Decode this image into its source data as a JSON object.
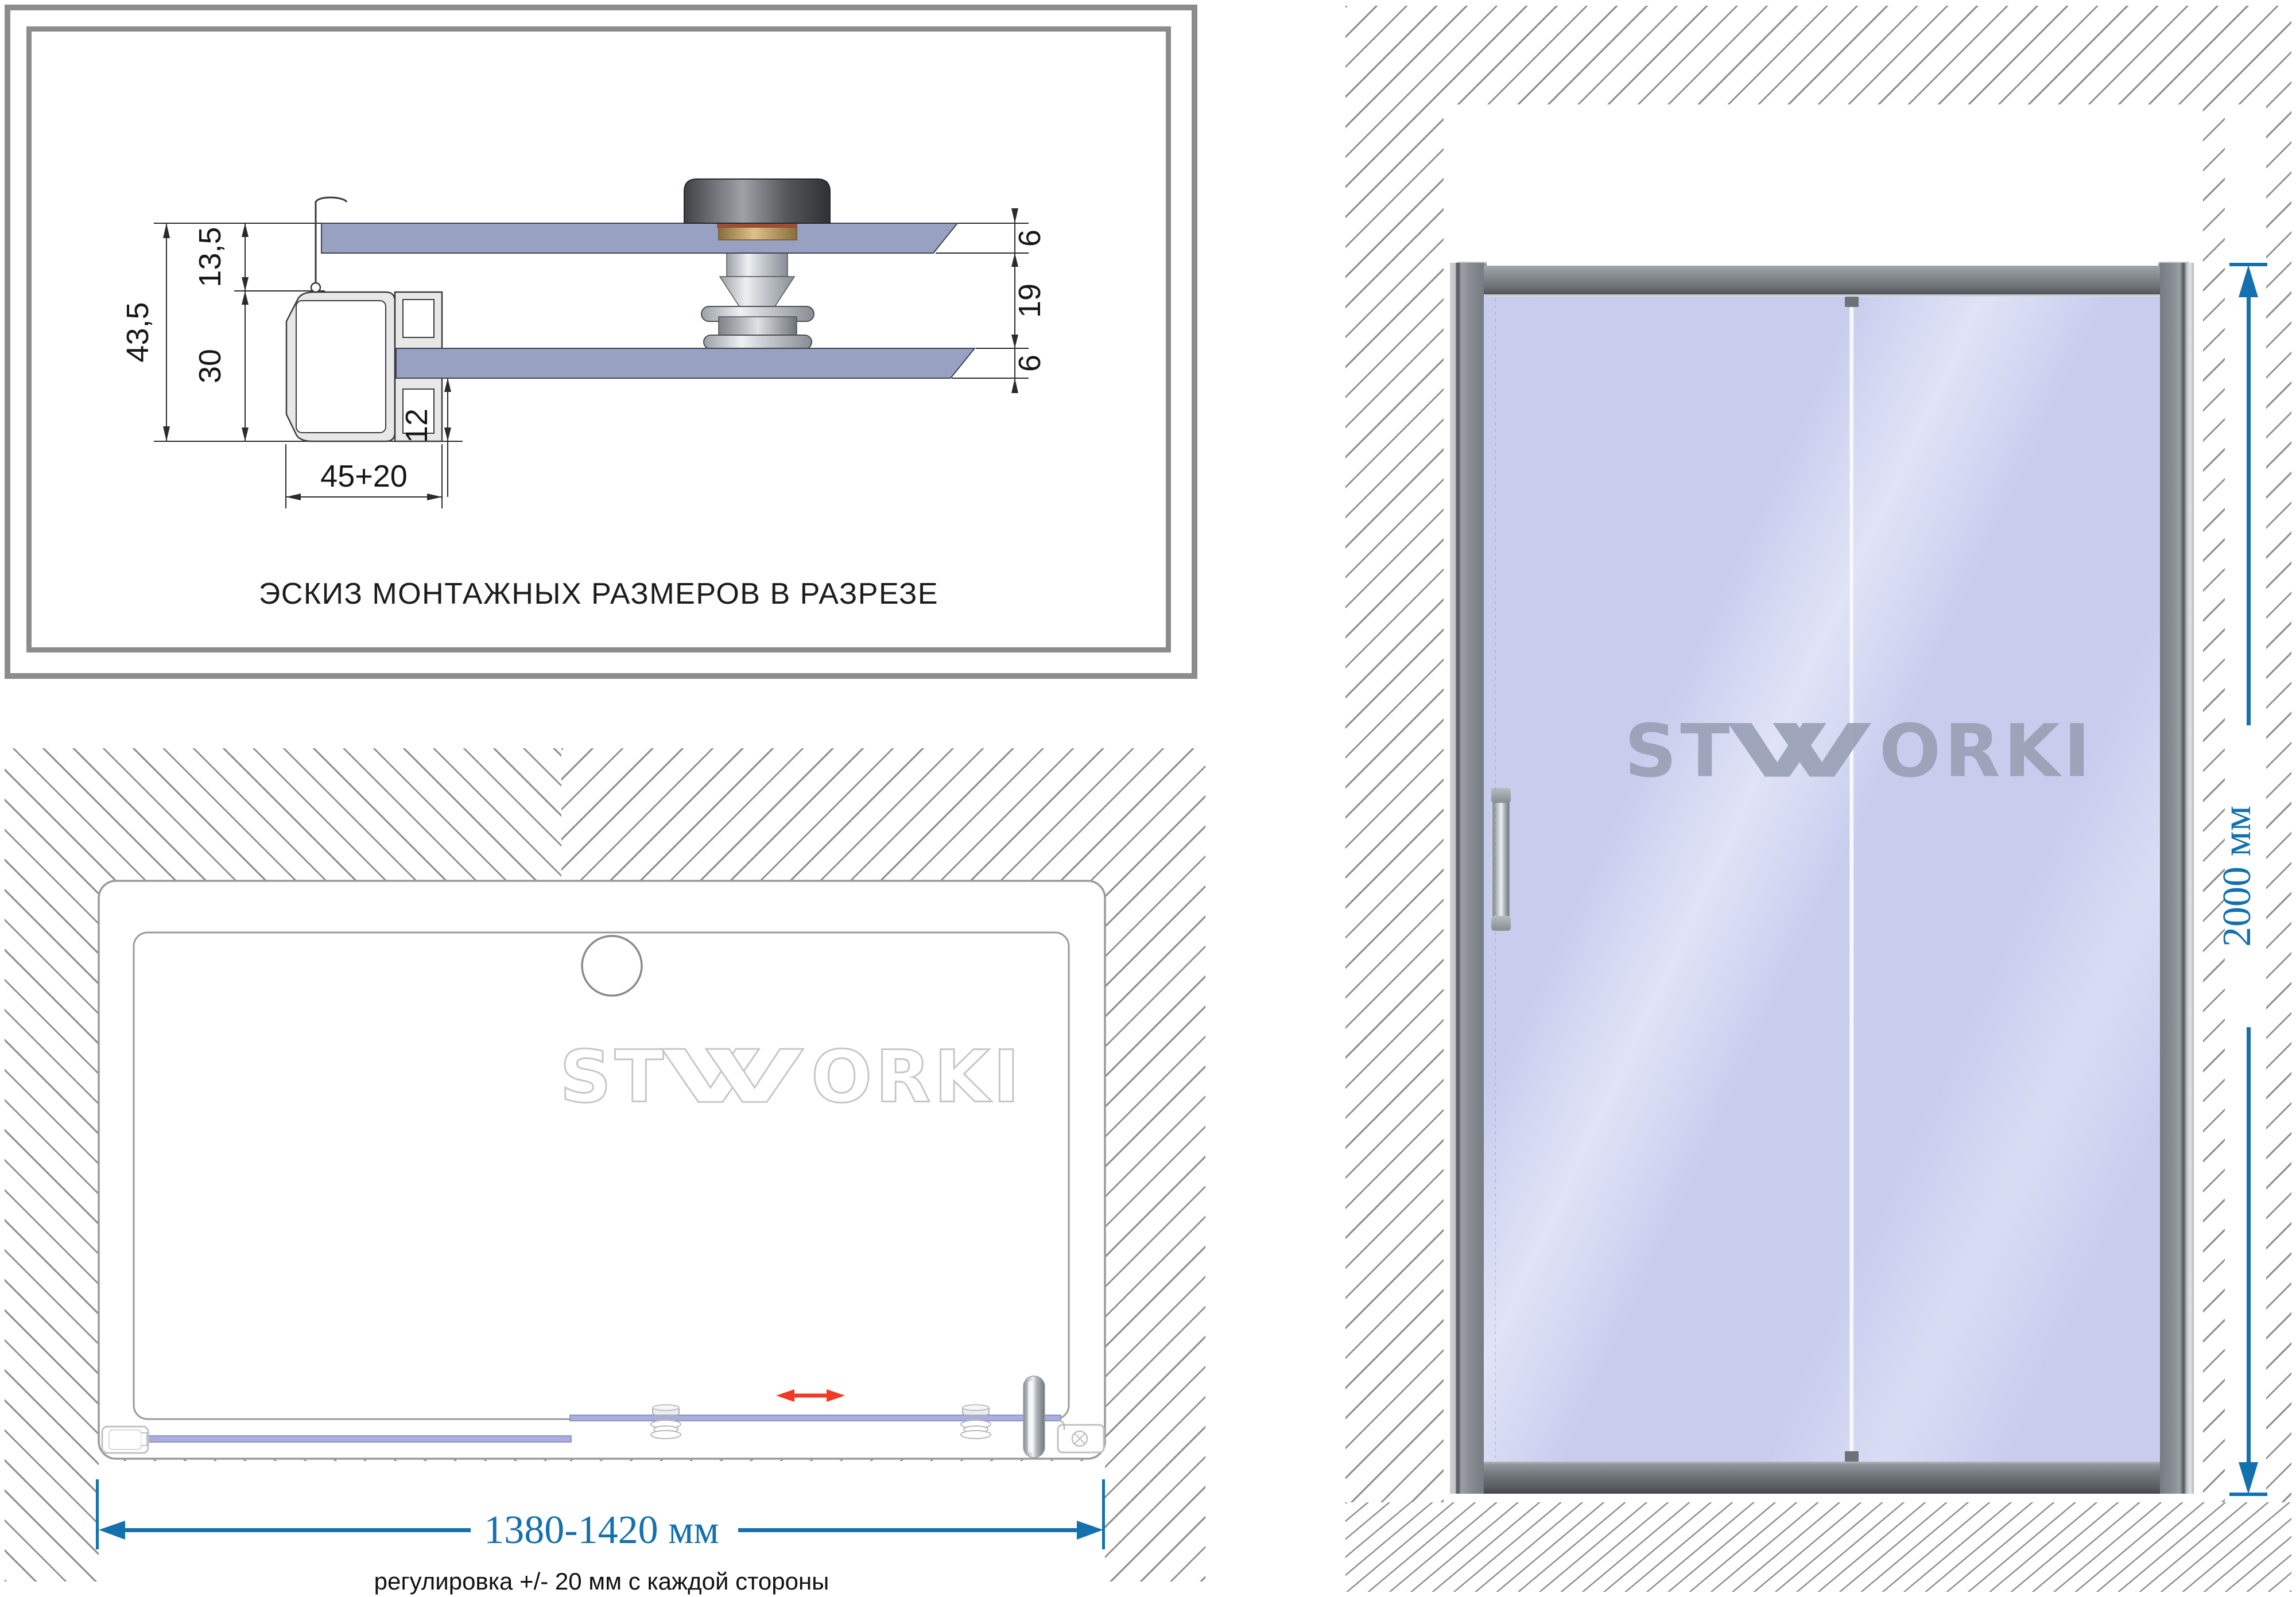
{
  "cross_section": {
    "caption": "ЭСКИЗ МОНТАЖНЫХ РАЗМЕРОВ В РАЗРЕЗЕ",
    "dim_total_height": "43,5",
    "dim_top_offset": "13,5",
    "dim_profile_height": "30",
    "dim_profile_width": "45+20",
    "dim_bottom_inset": "12",
    "dim_glass_top": "6",
    "dim_roller_gap": "19",
    "dim_glass_bottom": "6"
  },
  "plan_view": {
    "dim_width_range": "1380-1420 мм",
    "note": "регулировка +/- 20 мм с каждой стороны"
  },
  "front_view": {
    "dim_height": "2000 мм"
  },
  "brand": {
    "left_letters": "ST",
    "right_letters": "ORKI",
    "full_name": "STWORKI"
  },
  "colors": {
    "dimension_blue": "#1371ad",
    "arrow_red": "#f13a26",
    "glass_front": "#c8cdee",
    "glass_plan": "#a9aede",
    "hatch_gray": "#8f8f8f",
    "frame_gray": "#8c8c8c"
  }
}
